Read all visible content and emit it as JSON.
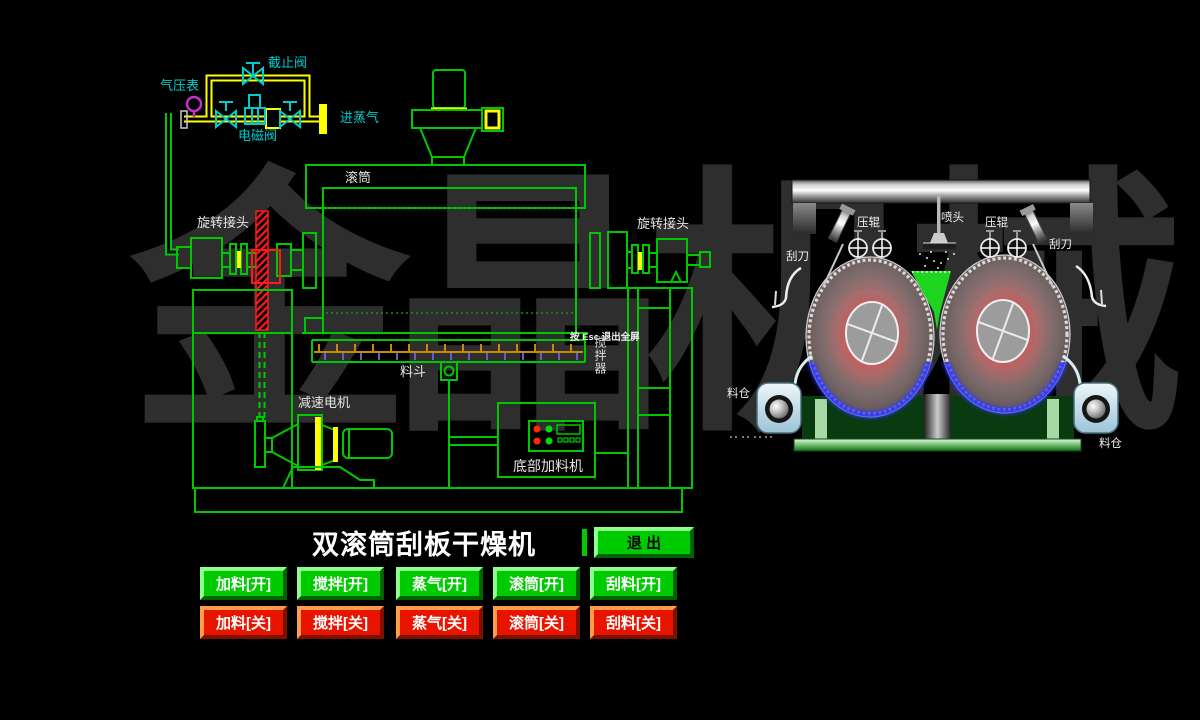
{
  "title": "双滚筒刮板干燥机",
  "window": {
    "fullscreen_hint": "按 Esc 退出全屏",
    "watermark": "金晶机械"
  },
  "schematic": {
    "labels": {
      "pressure_gauge": "气压表",
      "stop_valve": "截止阀",
      "solenoid_valve": "电磁阀",
      "steam_inlet": "进蒸气",
      "drum": "滚筒",
      "rotary_joint_left": "旋转接头",
      "rotary_joint_right": "旋转接头",
      "agitator": "搅拌器",
      "hopper": "料斗",
      "gear_motor": "减速电机",
      "bottom_feeder": "底部加料机"
    }
  },
  "drum_view": {
    "labels": {
      "press_roller_left": "压辊",
      "spray_head": "喷头",
      "press_roller_right": "压辊",
      "scraper_left": "刮刀",
      "scraper_right": "刮刀",
      "bin_left": "料仓",
      "bin_right": "料仓"
    }
  },
  "controls": {
    "exit_label": "退 出",
    "on_buttons": [
      "加料[开]",
      "搅拌[开]",
      "蒸气[开]",
      "滚筒[开]",
      "刮料[开]"
    ],
    "off_buttons": [
      "加料[关]",
      "搅拌[关]",
      "蒸气[关]",
      "滚筒[关]",
      "刮料[关]"
    ]
  },
  "colors": {
    "line_green": "#00c800",
    "pipe_yellow": "#ffff00",
    "valve_cyan": "#00cccc",
    "gauge_purple": "#c433c4",
    "belt_red": "#ff1a1a",
    "rake_orange": "#cc8a00",
    "rake_blue": "#6060cc",
    "label_white": "#e6e6e6",
    "button_green": "#00cb00",
    "button_red": "#e81400",
    "bevel_green_light": "#8cff8c",
    "bevel_green_dark": "#006200",
    "bevel_red_light": "#ff9e4a",
    "bevel_red_dark": "#7e1000",
    "watermark_gray": "#2e2e2e",
    "drum_glow_red": "#c06060",
    "material_green": "#1fd41f"
  }
}
